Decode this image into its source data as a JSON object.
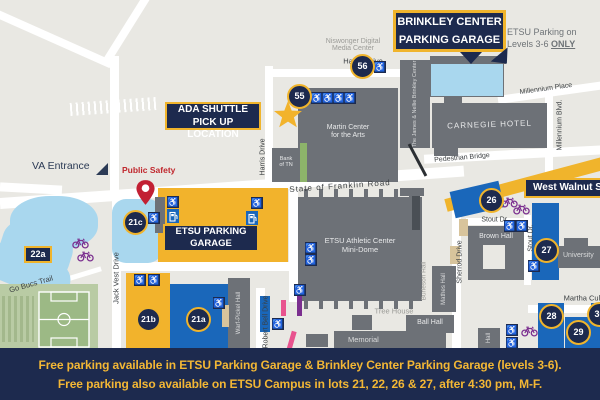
{
  "colors": {
    "navy": "#1d2a4e",
    "gold": "#f0b42c",
    "lot_blue": "#1a67ba",
    "water_blue": "#a9d7ee",
    "building_gray": "#6d7177",
    "map_bg": "#e9e8e3",
    "pin_red": "#c22033",
    "bike_purple": "#7b2f8f",
    "pink": "#e8538e",
    "field_green": "#b9cba4",
    "banner_text_gold": "#f3b735"
  },
  "banner": {
    "line1": "Free parking available in ETSU Parking Garage & Brinkley Center Parking Garage (levels 3-6).",
    "line2": "Free parking also available on ETSU Campus in lots 21, 22, 26 & 27, after 4:30 pm, M-F."
  },
  "callouts": {
    "brinkley_line1": "BRINKLEY CENTER",
    "brinkley_line2": "PARKING GARAGE",
    "ada_line1": "ADA SHUTTLE",
    "ada_line2": "PICK UP LOCATION",
    "west_walnut": "West Walnut St.",
    "garage_line1": "ETSU PARKING",
    "garage_line2": "GARAGE",
    "note_line1": "ETSU Parking on",
    "note_line2_prefix": "Levels 3-6 ",
    "note_line2_emph": "ONLY",
    "va_entrance": "VA Entrance",
    "public_safety": "Public Safety"
  },
  "streets": {
    "harris_top": "Harris Drive",
    "harris_vert": "Harris Drive",
    "franklin": "State of Franklin Road",
    "jack_vest": "Jack Vest Drive",
    "millennium_place": "Millennium Place",
    "millennium_blvd": "Millennium Blvd.",
    "pedestrian_bridge": "Pedestrian Bridge",
    "sherrod": "Sherrod Drive",
    "stout_h": "Stout Dr.",
    "stout_v": "Stout Dr.",
    "martha_culp": "Martha Culp",
    "robert_bell": "Robert Bell Drive",
    "go_bucs": "Go Bucs Trail"
  },
  "buildings": {
    "niswonger_line1": "Niswonger Digital",
    "niswonger_line2": "Media Center",
    "martin_line1": "Martin Center",
    "martin_line2": "for the Arts",
    "bank_line1": "Bank",
    "bank_line2": "of TN",
    "brinkley_center": "The James & Nellie Brinkley Center",
    "carnegie": "CARNEGIE HOTEL",
    "minidome_line1": "ETSU Athletic Center",
    "minidome_line2": "Mini-Dome",
    "burleson": "Burleson Hall",
    "mathes": "Mathes Hall",
    "ball": "Ball Hall",
    "tree_house": "Tree House",
    "memorial": "Memorial",
    "warf_pickel": "Warf-Pickel Hall",
    "brown": "Brown Hall",
    "university": "University",
    "hall": "Hall"
  },
  "badges": {
    "lot22a": "22a"
  },
  "icons": {
    "wheelchair_glyph": "♿"
  },
  "markers": [
    {
      "label": "55",
      "x": 299,
      "y": 96
    },
    {
      "label": "56",
      "x": 362,
      "y": 66
    },
    {
      "label": "21c",
      "x": 135,
      "y": 222
    },
    {
      "label": "21b",
      "x": 148,
      "y": 319
    },
    {
      "label": "21a",
      "x": 198,
      "y": 319
    },
    {
      "label": "26",
      "x": 491,
      "y": 200
    },
    {
      "label": "27",
      "x": 546,
      "y": 250
    },
    {
      "label": "28",
      "x": 551,
      "y": 316
    },
    {
      "label": "29",
      "x": 578,
      "y": 332
    },
    {
      "label": "30",
      "x": 599,
      "y": 314
    }
  ],
  "access_icons": [
    [
      311,
      92
    ],
    [
      322,
      92
    ],
    [
      333,
      92
    ],
    [
      344,
      92
    ],
    [
      374,
      61
    ],
    [
      167,
      196
    ],
    [
      251,
      197
    ],
    [
      148,
      212
    ],
    [
      134,
      274
    ],
    [
      148,
      274
    ],
    [
      213,
      297
    ],
    [
      305,
      242
    ],
    [
      305,
      254
    ],
    [
      294,
      284
    ],
    [
      504,
      220
    ],
    [
      516,
      220
    ],
    [
      528,
      260
    ],
    [
      506,
      324
    ],
    [
      506,
      337
    ],
    [
      272,
      318
    ]
  ],
  "ev_icons": [
    [
      167,
      209
    ],
    [
      246,
      211
    ]
  ],
  "bike_icons": [
    [
      72,
      236
    ],
    [
      77,
      249
    ],
    [
      501,
      195
    ],
    [
      513,
      202
    ],
    [
      521,
      324
    ]
  ]
}
